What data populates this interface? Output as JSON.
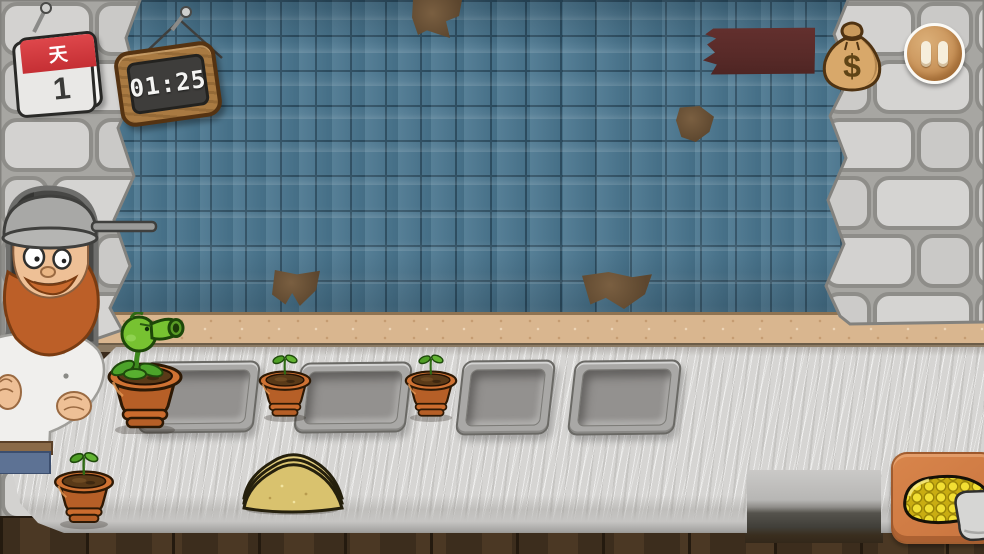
{
  "screen": {
    "width": 984,
    "height": 554,
    "scene": "kitchen-counter-level"
  },
  "hud": {
    "calendar": {
      "label": "天",
      "day": "1"
    },
    "timer": {
      "value": "01:25"
    },
    "money_bag": {
      "currency_symbol": "$"
    }
  },
  "counter": {
    "trays": [
      {
        "id": "tray-1",
        "state": "empty"
      },
      {
        "id": "tray-2",
        "state": "empty"
      },
      {
        "id": "tray-3",
        "state": "empty"
      },
      {
        "id": "tray-4",
        "state": "empty"
      }
    ],
    "pots": [
      {
        "id": "pot-1",
        "contents": "peashooter"
      },
      {
        "id": "pot-2",
        "contents": "sprout"
      },
      {
        "id": "pot-3",
        "contents": "sprout"
      },
      {
        "id": "pot-4",
        "contents": "sprout"
      }
    ],
    "ingredients": [
      {
        "id": "dough-pile",
        "type": "dough"
      },
      {
        "id": "corn-card",
        "type": "corn"
      }
    ]
  },
  "colors": {
    "tile": "#4a768f",
    "tile_grout": "#2e4f63",
    "stone": "#d2d1cf",
    "backsplash": "#d9b68f",
    "counter": "#d6d5d3",
    "banner": "#5d2c2a",
    "pot_terracotta": "#c9682b",
    "plant_green": "#77c231",
    "corn_yellow": "#f2dd2e",
    "card_orange": "#d07f46",
    "pause_tan": "#cf9a62",
    "calendar_red": "#d6373c",
    "timer_wood": "#a97a42",
    "screen_dark": "#3e3d3b"
  }
}
